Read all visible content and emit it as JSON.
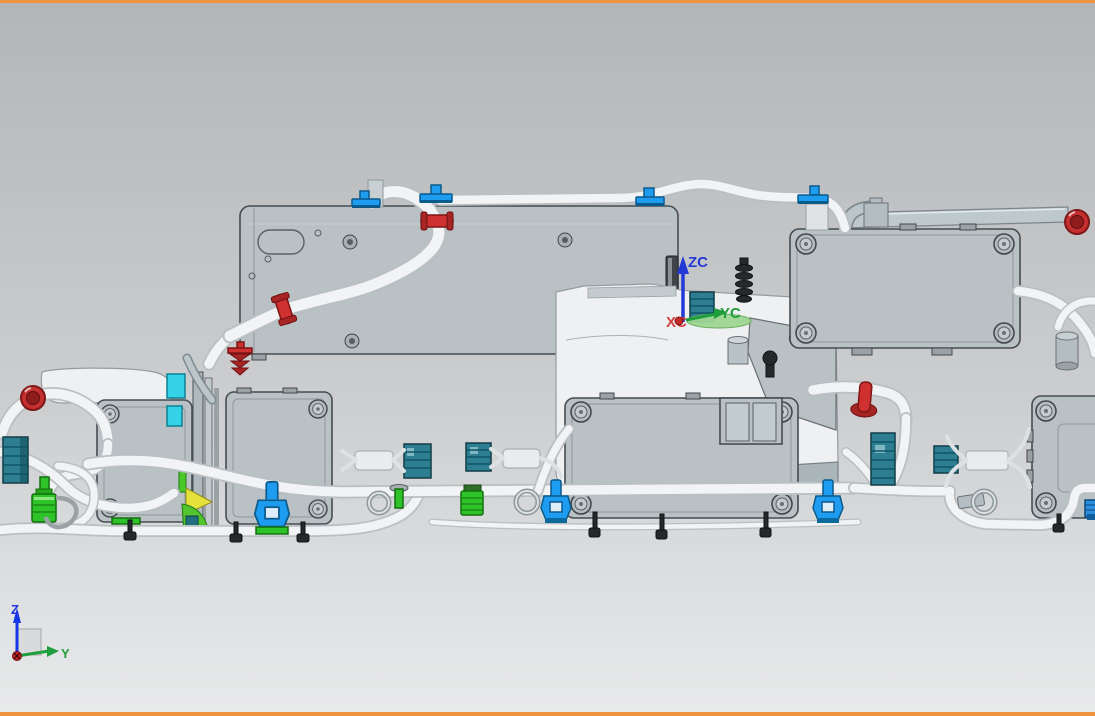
{
  "window": {
    "top_border": true,
    "bottom_border": true
  },
  "wcs": {
    "labels": {
      "z": "ZC",
      "y": "YC",
      "x": "XC"
    }
  },
  "triad": {
    "labels": {
      "z": "Z",
      "y": "Y"
    }
  },
  "colors": {
    "border_orange": "#f0953f",
    "background_top": "#b3b5b7",
    "background_mid": "#cbcdcf",
    "background_bottom": "#e9eaeb",
    "panel_gray": "#b9c1c5",
    "panel_outline": "#464c51",
    "housing_white": "#eef0f1",
    "tube_white": "#f1f3f4",
    "tube_shadow": "#b9bfc2",
    "clip_red": "#cf3030",
    "clip_blue": "#1e9df0",
    "connector_teal": "#2e7e92",
    "connector_green": "#2fc32a",
    "accent_cyan": "#35d2e8",
    "accent_yellow": "#e6e23c",
    "dark_part": "#26292c",
    "wcs_z_blue": "#2438d8",
    "wcs_y_green": "#1f9e3d",
    "wcs_x_red": "#d34040",
    "grommet_red": "#c62f2f"
  }
}
